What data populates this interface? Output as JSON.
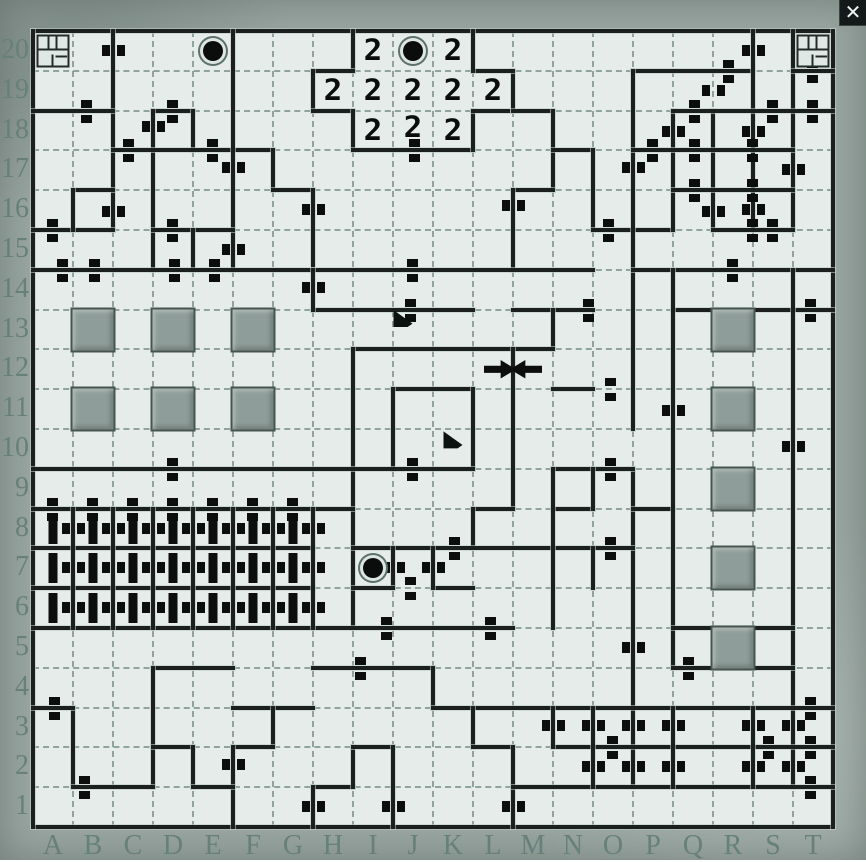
{
  "close_button": {
    "glyph": "✕"
  },
  "map": {
    "columns": [
      "A",
      "B",
      "C",
      "D",
      "E",
      "F",
      "G",
      "H",
      "I",
      "J",
      "K",
      "L",
      "M",
      "N",
      "O",
      "P",
      "Q",
      "R",
      "S",
      "T"
    ],
    "rows": [
      "20",
      "19",
      "18",
      "17",
      "16",
      "15",
      "14",
      "13",
      "12",
      "11",
      "10",
      "9",
      "8",
      "7",
      "6",
      "5",
      "4",
      "3",
      "2",
      "1"
    ],
    "colors": {
      "frame": "#99a6a1",
      "paper": "#e5ecea",
      "wall": "#1b201f",
      "grid_dash": "#6c847e",
      "label": "#67807a",
      "pillar": "#8f9d9a",
      "marker": "#0b0e0d"
    },
    "walls": [
      [
        "h",
        0,
        0,
        20
      ],
      [
        "h",
        0,
        20,
        20
      ],
      [
        "v",
        0,
        0,
        20
      ],
      [
        "v",
        20,
        0,
        20
      ],
      [
        "v",
        2,
        0,
        5
      ],
      [
        "h",
        0,
        2,
        2
      ],
      [
        "h",
        3,
        2,
        1
      ],
      [
        "v",
        3,
        2,
        4
      ],
      [
        "v",
        4,
        2,
        1
      ],
      [
        "h",
        2,
        3,
        4
      ],
      [
        "v",
        5,
        0,
        6
      ],
      [
        "v",
        6,
        3,
        1
      ],
      [
        "h",
        6,
        4,
        1
      ],
      [
        "v",
        7,
        4,
        2
      ],
      [
        "h",
        0,
        5,
        2
      ],
      [
        "h",
        1,
        4,
        1
      ],
      [
        "v",
        1,
        4,
        1
      ],
      [
        "h",
        3,
        5,
        2
      ],
      [
        "v",
        4,
        5,
        1
      ],
      [
        "v",
        8,
        0,
        1
      ],
      [
        "h",
        7,
        1,
        1
      ],
      [
        "v",
        7,
        1,
        1
      ],
      [
        "h",
        7,
        2,
        1
      ],
      [
        "v",
        8,
        2,
        1
      ],
      [
        "h",
        8,
        3,
        3
      ],
      [
        "v",
        11,
        2,
        1
      ],
      [
        "h",
        11,
        2,
        1
      ],
      [
        "v",
        12,
        1,
        1
      ],
      [
        "h",
        11,
        1,
        1
      ],
      [
        "v",
        11,
        0,
        1
      ],
      [
        "h",
        12,
        2,
        1
      ],
      [
        "v",
        13,
        2,
        2
      ],
      [
        "h",
        13,
        3,
        1
      ],
      [
        "h",
        12,
        4,
        1
      ],
      [
        "v",
        12,
        4,
        2
      ],
      [
        "v",
        14,
        3,
        2
      ],
      [
        "h",
        14,
        5,
        2
      ],
      [
        "h",
        15,
        1,
        3
      ],
      [
        "v",
        15,
        1,
        9
      ],
      [
        "v",
        15,
        11,
        8
      ],
      [
        "v",
        16,
        2,
        3
      ],
      [
        "v",
        17,
        2,
        3
      ],
      [
        "v",
        18,
        0,
        5
      ],
      [
        "v",
        19,
        0,
        5
      ],
      [
        "h",
        19,
        1,
        1
      ],
      [
        "h",
        16,
        2,
        4
      ],
      [
        "h",
        15,
        3,
        4
      ],
      [
        "h",
        16,
        4,
        3
      ],
      [
        "h",
        17,
        5,
        2
      ],
      [
        "h",
        0,
        6,
        14
      ],
      [
        "h",
        15,
        6,
        5
      ],
      [
        "h",
        7,
        7,
        4
      ],
      [
        "h",
        12,
        7,
        2
      ],
      [
        "h",
        16,
        7,
        4
      ],
      [
        "v",
        7,
        6,
        1
      ],
      [
        "v",
        13,
        7,
        1
      ],
      [
        "h",
        13,
        9,
        1
      ],
      [
        "h",
        8,
        8,
        5
      ],
      [
        "v",
        8,
        8,
        7
      ],
      [
        "v",
        12,
        8,
        4
      ],
      [
        "h",
        9,
        9,
        2
      ],
      [
        "v",
        9,
        9,
        2
      ],
      [
        "v",
        11,
        9,
        2
      ],
      [
        "h",
        0,
        11,
        11
      ],
      [
        "h",
        13,
        11,
        2
      ],
      [
        "h",
        11,
        12,
        1
      ],
      [
        "v",
        11,
        12,
        1
      ],
      [
        "h",
        8,
        13,
        7
      ],
      [
        "h",
        13,
        12,
        1
      ],
      [
        "v",
        14,
        11,
        1
      ],
      [
        "v",
        13,
        11,
        4
      ],
      [
        "v",
        14,
        13,
        1
      ],
      [
        "h",
        15,
        12,
        1
      ],
      [
        "v",
        16,
        6,
        10
      ],
      [
        "v",
        19,
        6,
        13
      ],
      [
        "v",
        9,
        13,
        1
      ],
      [
        "h",
        8,
        14,
        1
      ],
      [
        "h",
        10,
        14,
        1
      ],
      [
        "v",
        10,
        13,
        1
      ],
      [
        "h",
        0,
        12,
        8
      ],
      [
        "h",
        0,
        13,
        7
      ],
      [
        "h",
        0,
        14,
        7
      ],
      [
        "h",
        0,
        15,
        12
      ],
      [
        "v",
        1,
        12,
        3
      ],
      [
        "v",
        2,
        12,
        3
      ],
      [
        "v",
        3,
        12,
        3
      ],
      [
        "v",
        4,
        12,
        3
      ],
      [
        "v",
        5,
        12,
        3
      ],
      [
        "v",
        6,
        12,
        3
      ],
      [
        "v",
        7,
        12,
        3
      ],
      [
        "h",
        16,
        15,
        3
      ],
      [
        "h",
        16,
        16,
        3
      ],
      [
        "h",
        3,
        16,
        2
      ],
      [
        "h",
        7,
        16,
        3
      ],
      [
        "v",
        10,
        16,
        1
      ],
      [
        "v",
        3,
        16,
        3
      ],
      [
        "v",
        1,
        17,
        2
      ],
      [
        "h",
        0,
        17,
        1
      ],
      [
        "h",
        5,
        17,
        2
      ],
      [
        "v",
        6,
        17,
        1
      ],
      [
        "h",
        5,
        18,
        1
      ],
      [
        "v",
        5,
        18,
        2
      ],
      [
        "h",
        1,
        19,
        2
      ],
      [
        "h",
        3,
        18,
        1
      ],
      [
        "v",
        4,
        18,
        1
      ],
      [
        "h",
        4,
        19,
        1
      ],
      [
        "h",
        10,
        17,
        10
      ],
      [
        "v",
        11,
        17,
        1
      ],
      [
        "h",
        11,
        18,
        1
      ],
      [
        "v",
        12,
        18,
        2
      ],
      [
        "h",
        7,
        19,
        1
      ],
      [
        "v",
        7,
        19,
        1
      ],
      [
        "v",
        8,
        18,
        1
      ],
      [
        "h",
        8,
        18,
        1
      ],
      [
        "v",
        9,
        18,
        2
      ],
      [
        "h",
        12,
        19,
        8
      ],
      [
        "h",
        13,
        18,
        7
      ],
      [
        "v",
        13,
        17,
        1
      ],
      [
        "v",
        14,
        17,
        2
      ],
      [
        "v",
        16,
        17,
        2
      ],
      [
        "v",
        18,
        17,
        2
      ]
    ],
    "doors": [
      [
        "v",
        2,
        0.5
      ],
      [
        "v",
        3,
        2.4
      ],
      [
        "v",
        5,
        3.45
      ],
      [
        "v",
        5,
        5.5
      ],
      [
        "v",
        7,
        4.5
      ],
      [
        "v",
        2,
        4.55
      ],
      [
        "v",
        12,
        4.4
      ],
      [
        "v",
        15,
        3.45
      ],
      [
        "v",
        16,
        2.55
      ],
      [
        "v",
        17,
        1.5
      ],
      [
        "v",
        17,
        4.55
      ],
      [
        "v",
        18,
        0.5
      ],
      [
        "v",
        18,
        2.55
      ],
      [
        "v",
        18,
        4.5
      ],
      [
        "v",
        19,
        3.5
      ],
      [
        "v",
        16,
        9.55
      ],
      [
        "v",
        19,
        10.45
      ],
      [
        "v",
        7,
        6.45
      ],
      [
        "v",
        9,
        13.5
      ],
      [
        "v",
        10,
        13.5
      ],
      [
        "v",
        15,
        15.5
      ],
      [
        "v",
        1,
        12.5
      ],
      [
        "v",
        2,
        12.5
      ],
      [
        "v",
        3,
        12.5
      ],
      [
        "v",
        4,
        12.5
      ],
      [
        "v",
        5,
        12.5
      ],
      [
        "v",
        6,
        12.5
      ],
      [
        "v",
        7,
        12.5
      ],
      [
        "v",
        1,
        13.5
      ],
      [
        "v",
        2,
        13.5
      ],
      [
        "v",
        3,
        13.5
      ],
      [
        "v",
        4,
        13.5
      ],
      [
        "v",
        5,
        13.5
      ],
      [
        "v",
        6,
        13.5
      ],
      [
        "v",
        7,
        13.5
      ],
      [
        "v",
        1,
        14.5
      ],
      [
        "v",
        2,
        14.5
      ],
      [
        "v",
        3,
        14.5
      ],
      [
        "v",
        4,
        14.5
      ],
      [
        "v",
        5,
        14.5
      ],
      [
        "v",
        6,
        14.5
      ],
      [
        "v",
        7,
        14.5
      ],
      [
        "v",
        13,
        17.45
      ],
      [
        "v",
        14,
        17.45
      ],
      [
        "v",
        14,
        18.5
      ],
      [
        "v",
        15,
        17.45
      ],
      [
        "v",
        15,
        18.5
      ],
      [
        "v",
        16,
        17.45
      ],
      [
        "v",
        16,
        18.5
      ],
      [
        "v",
        18,
        17.45
      ],
      [
        "v",
        18,
        18.5
      ],
      [
        "v",
        19,
        17.45
      ],
      [
        "v",
        19,
        18.5
      ],
      [
        "v",
        5,
        18.45
      ],
      [
        "v",
        9,
        19.5
      ],
      [
        "v",
        12,
        19.5
      ],
      [
        "v",
        7,
        19.5
      ],
      [
        "h",
        1.35,
        2
      ],
      [
        "h",
        3.5,
        2
      ],
      [
        "h",
        9.55,
        3
      ],
      [
        "h",
        2.4,
        3
      ],
      [
        "h",
        4.5,
        3
      ],
      [
        "h",
        0.5,
        5
      ],
      [
        "h",
        3.5,
        5
      ],
      [
        "h",
        14.4,
        5
      ],
      [
        "h",
        0.75,
        6
      ],
      [
        "h",
        1.55,
        6
      ],
      [
        "h",
        3.55,
        6
      ],
      [
        "h",
        4.55,
        6
      ],
      [
        "h",
        9.5,
        6
      ],
      [
        "h",
        17.5,
        6
      ],
      [
        "h",
        9.45,
        7
      ],
      [
        "h",
        13.9,
        7
      ],
      [
        "h",
        19.45,
        7
      ],
      [
        "h",
        14.45,
        9
      ],
      [
        "h",
        3.5,
        11
      ],
      [
        "h",
        9.5,
        11
      ],
      [
        "h",
        14.45,
        11
      ],
      [
        "h",
        0.5,
        12
      ],
      [
        "h",
        1.5,
        12
      ],
      [
        "h",
        2.5,
        12
      ],
      [
        "h",
        3.5,
        12
      ],
      [
        "h",
        4.5,
        12
      ],
      [
        "h",
        5.5,
        12
      ],
      [
        "h",
        6.5,
        12
      ],
      [
        "h",
        10.55,
        13
      ],
      [
        "h",
        14.45,
        13
      ],
      [
        "h",
        9.45,
        14
      ],
      [
        "h",
        8.85,
        15
      ],
      [
        "h",
        11.45,
        15
      ],
      [
        "h",
        8.2,
        16
      ],
      [
        "h",
        16.4,
        16
      ],
      [
        "h",
        0.55,
        17
      ],
      [
        "h",
        19.45,
        17
      ],
      [
        "h",
        1.3,
        19
      ],
      [
        "h",
        14.5,
        18
      ],
      [
        "h",
        18.4,
        18
      ],
      [
        "h",
        19.45,
        18
      ],
      [
        "h",
        19.45,
        19
      ],
      [
        "h",
        16.55,
        2
      ],
      [
        "h",
        18.5,
        2
      ],
      [
        "h",
        19.5,
        2
      ],
      [
        "h",
        15.5,
        3
      ],
      [
        "h",
        16.55,
        3
      ],
      [
        "h",
        18,
        3
      ],
      [
        "h",
        16.55,
        4
      ],
      [
        "h",
        18,
        4
      ],
      [
        "h",
        18,
        5
      ],
      [
        "h",
        18.5,
        5
      ],
      [
        "h",
        17.4,
        1
      ],
      [
        "h",
        19.5,
        1
      ]
    ],
    "icons": [
      [
        "stairs",
        0,
        0
      ],
      [
        "stairs",
        19,
        0
      ],
      [
        "portal",
        4,
        0
      ],
      [
        "portal",
        9,
        0
      ],
      [
        "portal",
        8,
        13
      ],
      [
        "two",
        8,
        0
      ],
      [
        "two",
        10,
        0
      ],
      [
        "two",
        7,
        1
      ],
      [
        "two",
        8,
        1
      ],
      [
        "two",
        9,
        1
      ],
      [
        "two",
        10,
        1
      ],
      [
        "two",
        11,
        1
      ],
      [
        "two",
        8,
        2
      ],
      [
        "two",
        9,
        2,
        0,
        -3
      ],
      [
        "two",
        10,
        2
      ],
      [
        "flag",
        9,
        7,
        -10,
        -11
      ],
      [
        "flag",
        10,
        10,
        0,
        -9
      ],
      [
        "arrow-e",
        11,
        8,
        7,
        0
      ],
      [
        "arrow-w",
        12,
        8,
        -7,
        0
      ],
      [
        "pillar",
        1,
        7
      ],
      [
        "pillar",
        3,
        7
      ],
      [
        "pillar",
        5,
        7
      ],
      [
        "pillar",
        1,
        9
      ],
      [
        "pillar",
        3,
        9
      ],
      [
        "pillar",
        5,
        9
      ],
      [
        "pillar",
        17,
        7
      ],
      [
        "pillar",
        17,
        9
      ],
      [
        "pillar",
        17,
        11
      ],
      [
        "pillar",
        17,
        13
      ],
      [
        "pillar",
        17,
        15
      ],
      [
        "bar",
        0,
        12
      ],
      [
        "bar",
        1,
        12
      ],
      [
        "bar",
        2,
        12
      ],
      [
        "bar",
        3,
        12
      ],
      [
        "bar",
        4,
        12
      ],
      [
        "bar",
        5,
        12
      ],
      [
        "bar",
        6,
        12
      ],
      [
        "bar",
        0,
        13
      ],
      [
        "bar",
        1,
        13
      ],
      [
        "bar",
        2,
        13
      ],
      [
        "bar",
        3,
        13
      ],
      [
        "bar",
        4,
        13
      ],
      [
        "bar",
        5,
        13
      ],
      [
        "bar",
        6,
        13
      ],
      [
        "bar",
        0,
        14
      ],
      [
        "bar",
        1,
        14
      ],
      [
        "bar",
        2,
        14
      ],
      [
        "bar",
        3,
        14
      ],
      [
        "bar",
        4,
        14
      ],
      [
        "bar",
        5,
        14
      ],
      [
        "bar",
        6,
        14
      ]
    ]
  }
}
